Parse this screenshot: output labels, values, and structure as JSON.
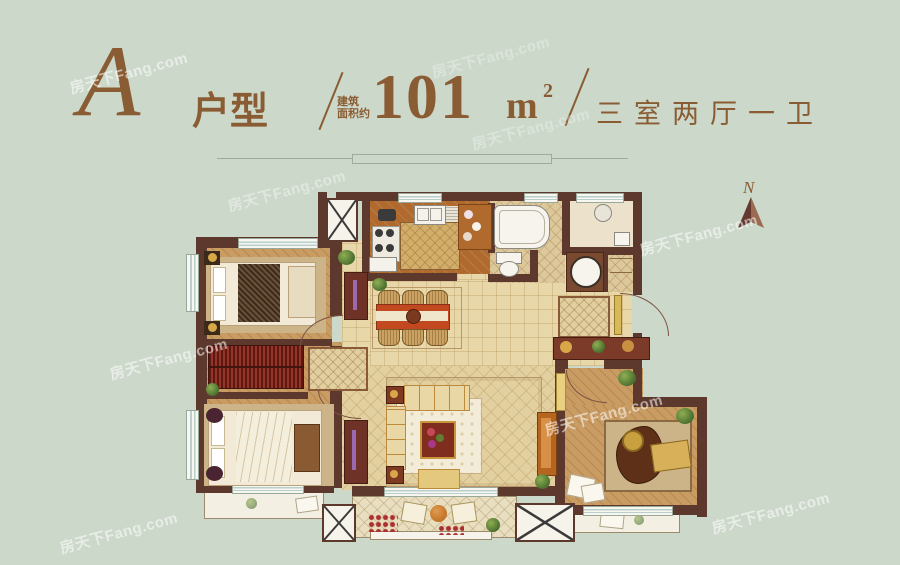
{
  "header": {
    "plan_letter": "A",
    "plan_type_label": "户型",
    "area_note_line1": "建筑",
    "area_note_line2": "面积约",
    "area_value": "101",
    "area_unit": "m",
    "area_unit_sup": "2",
    "layout_label": "三室两厅一卫"
  },
  "compass": {
    "label": "N"
  },
  "watermark": {
    "text": "房天下Fang.com"
  },
  "colors": {
    "background": "#ccd8ca",
    "title_brown": "#8a5c33",
    "wall": "#5d392d",
    "hall_floor": "#e8d7a8",
    "wood_floor": "#c99c63",
    "kitchen_floor": "#b06a2e",
    "dining_table_red": "#c2491f",
    "sofa_cream": "#e9d7a5",
    "wardrobe_red": "#7c2117",
    "compass_brown": "#8a5a47"
  }
}
